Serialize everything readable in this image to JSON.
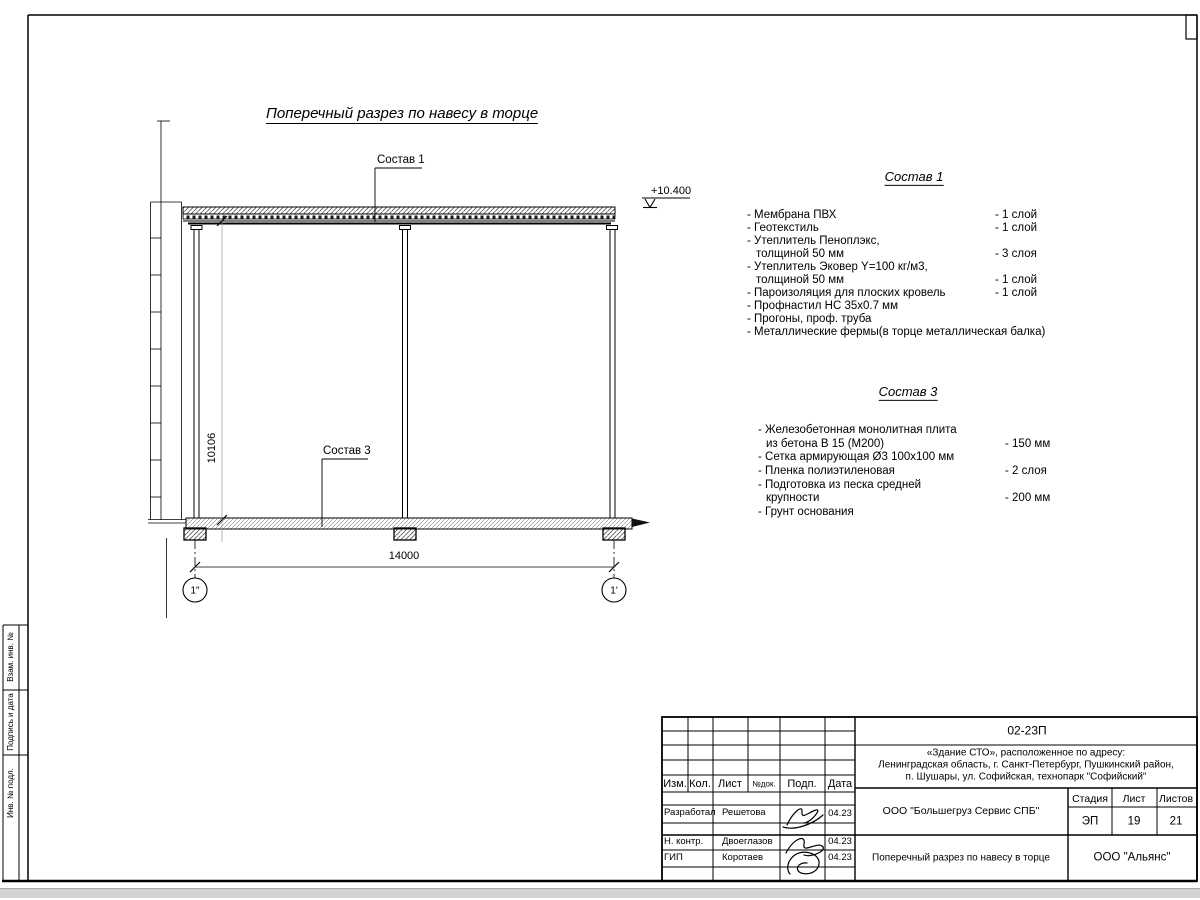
{
  "drawing": {
    "title": "Поперечный разрез по навесу в торце",
    "elevation": "+10.400",
    "callouts": {
      "roof": "Состав 1",
      "slab": "Состав 3"
    },
    "dim_width": "14000",
    "dim_height": "10106",
    "axis_left": "1\"",
    "axis_right": "1'"
  },
  "sostav1": {
    "heading": "Состав 1",
    "items": [
      {
        "name": "- Мембрана ПВХ",
        "qty": "- 1 слой"
      },
      {
        "name": "- Геотекстиль",
        "qty": "- 1 слой"
      },
      {
        "name": "- Утеплитель Пеноплэкс,",
        "qty": ""
      },
      {
        "name": "толщиной 50 мм",
        "qty": "- 3 слоя"
      },
      {
        "name": "- Утеплитель Эковер Y=100 кг/м3,",
        "qty": ""
      },
      {
        "name": "толщиной 50 мм",
        "qty": "- 1 слой"
      },
      {
        "name": "- Пароизоляция для плоских кровель",
        "qty": "- 1 слой"
      },
      {
        "name": "- Профнастил НС 35х0.7 мм",
        "qty": ""
      },
      {
        "name": "- Прогоны, проф. труба",
        "qty": ""
      },
      {
        "name": "- Металлические фермы(в торце металлическая балка)",
        "qty": ""
      }
    ]
  },
  "sostav3": {
    "heading": "Состав 3",
    "items": [
      {
        "name": "- Железобетонная  монолитная плита",
        "qty": ""
      },
      {
        "name": "из бетона В 15 (М200)",
        "qty": "- 150 мм"
      },
      {
        "name": "- Сетка армирующая Ø3 100x100 мм",
        "qty": ""
      },
      {
        "name": "- Пленка полиэтиленовая",
        "qty": "-  2 слоя"
      },
      {
        "name": "- Подготовка из песка средней",
        "qty": ""
      },
      {
        "name": "крупности",
        "qty": "- 200 мм"
      },
      {
        "name": "- Грунт основания",
        "qty": ""
      }
    ]
  },
  "sidebar": {
    "label_1": "Взам. инв. №",
    "label_2": "Подпись и дата",
    "label_3": "Инв. № подл."
  },
  "titleblock": {
    "doc_number": "02-23П",
    "address_line1": "«Здание СТО», расположенное по адресу:",
    "address_line2": "Ленинградская область, г. Санкт-Петербург, Пушкинский район,",
    "address_line3": "п. Шушары, ул. Софийская, технопарк \"Софийский\"",
    "header_cols": {
      "izm": "Изм.",
      "kol": "Кол.",
      "list": "Лист",
      "ndok": "№док.",
      "podp": "Подп.",
      "data": "Дата"
    },
    "rows": [
      {
        "role": "Разработал",
        "name": "Решетова",
        "date": "04.23"
      },
      {
        "role": "Н. контр.",
        "name": "Двоеглазов",
        "date": "04.23"
      },
      {
        "role": "ГИП",
        "name": "Коротаев",
        "date": "04.23"
      }
    ],
    "company": "ООО \"Большегруз Сервис СПБ\"",
    "stage_label": "Стадия",
    "sheet_label": "Лист",
    "sheets_label": "Листов",
    "stage": "ЭП",
    "sheet": "19",
    "sheets": "21",
    "sheet_title": "Поперечный разрез по навесу в торце",
    "contractor": "ООО \"Альянс\""
  }
}
